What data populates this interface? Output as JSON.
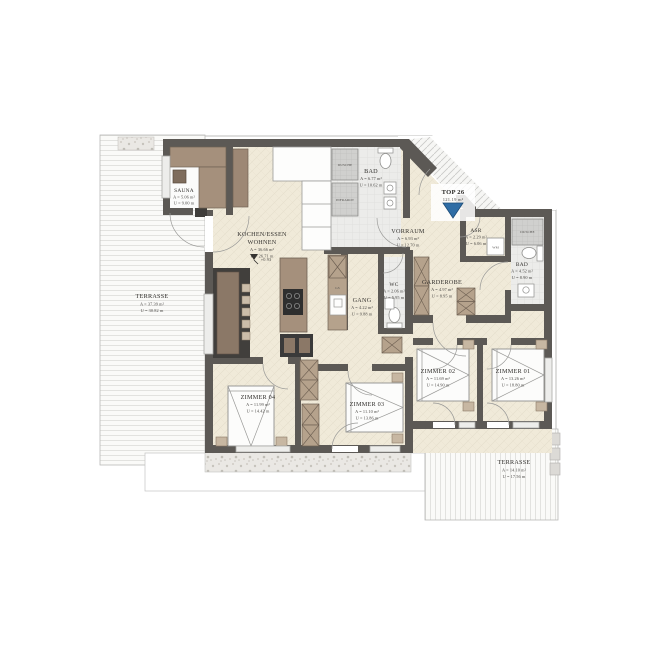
{
  "unit": {
    "label": "TOP 26",
    "area": "121.19 m²"
  },
  "rooms": {
    "sauna": {
      "name": "SAUNA",
      "area": "A = 5.06 m²",
      "perimeter": "U = 9.00 m"
    },
    "kochen_essen_wohnen": {
      "name_line1": "KOCHEN/ESSEN",
      "name_line2": "WOHNEN",
      "area": "A = 36.66 m²",
      "perimeter": "U = 26.71 m",
      "level": "+0.93"
    },
    "bad_top": {
      "name": "BAD",
      "area": "A = 6.77 m²",
      "perimeter": "U = 10.62 m"
    },
    "vorraum": {
      "name": "VORRAUM",
      "area": "A = 6.93 m²",
      "perimeter": "U = 12.70 m"
    },
    "asr": {
      "name": "ASR",
      "area": "A = 2.29 m²",
      "perimeter": "U = 6.06 m"
    },
    "bad_right": {
      "name": "BAD",
      "area": "A = 4.52 m²",
      "perimeter": "U = 8.90 m"
    },
    "wc": {
      "name": "WC",
      "area": "A = 2.06 m²",
      "perimeter": "U = 5.95 m"
    },
    "gang": {
      "name": "GANG",
      "area": "A = 4.22 m²",
      "perimeter": "U = 9.88 m"
    },
    "garderobe": {
      "name": "GARDEROBE",
      "area": "A = 4.97 m²",
      "perimeter": "U = 8.95 m"
    },
    "zimmer01": {
      "name": "ZIMMER 01",
      "area": "A = 13.26 m²",
      "perimeter": "U = 18.80 m"
    },
    "zimmer02": {
      "name": "ZIMMER 02",
      "area": "A = 11.69 m²",
      "perimeter": "U = 14.90 m"
    },
    "zimmer03": {
      "name": "ZIMMER 03",
      "area": "A = 11.10 m²",
      "perimeter": "U = 13.86 m"
    },
    "zimmer04": {
      "name": "ZIMMER 04",
      "area": "A = 11.99 m²",
      "perimeter": "U = 14.42 m"
    },
    "terrasse_west": {
      "name": "TERRASSE",
      "area": "A = 37.39 m²",
      "perimeter": "U = 30.82 m"
    },
    "terrasse_sued": {
      "name": "TERRASSE",
      "area": "A = 14.10 m²",
      "perimeter": "U = 17.56 m"
    }
  },
  "fixtures": {
    "dusche_bad_top": "DUSCHE",
    "infrarot": "INFRAROT",
    "dusche_bad_right": "DUSCHE",
    "wm": "WM",
    "gs": "GS"
  },
  "colors": {
    "wall": "#5c5955",
    "floor": "#f0ead9",
    "wood": "#a5907c",
    "entrance_marker_blue": "#2f6da5"
  }
}
